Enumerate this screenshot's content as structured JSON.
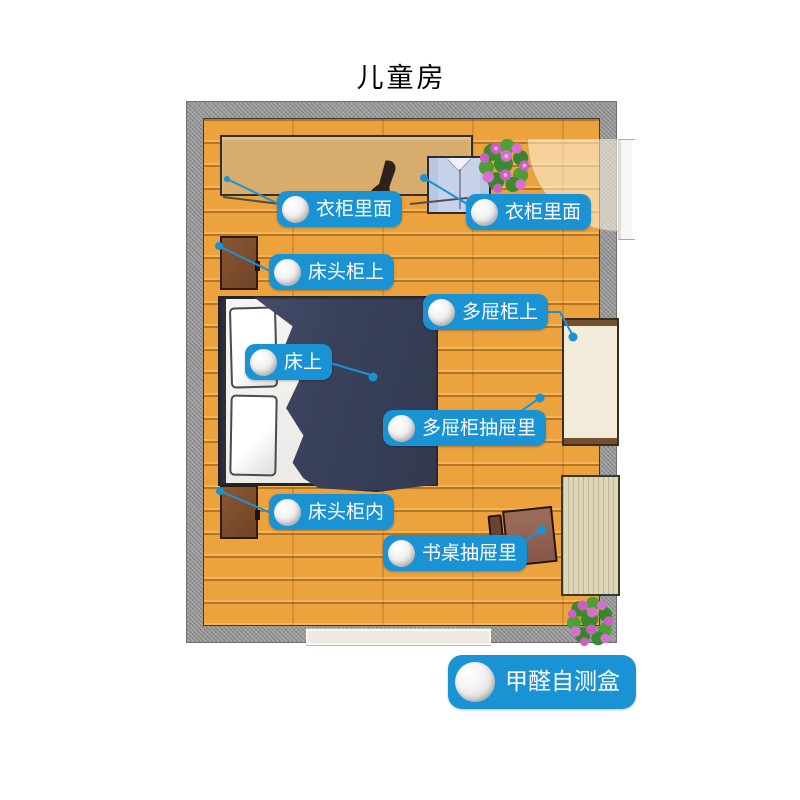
{
  "title": "儿童房",
  "markers": [
    {
      "id": "wardrobe-left",
      "text": "衣柜里面"
    },
    {
      "id": "wardrobe-right",
      "text": "衣柜里面"
    },
    {
      "id": "nightstand-top",
      "text": "床头柜上"
    },
    {
      "id": "dresser-top",
      "text": "多屉柜上"
    },
    {
      "id": "bed-top",
      "text": "床上"
    },
    {
      "id": "dresser-drawer",
      "text": "多屉柜抽屉里"
    },
    {
      "id": "nightstand-inside",
      "text": "床头柜内"
    },
    {
      "id": "desk-drawer",
      "text": "书桌抽屉里"
    }
  ],
  "legend": {
    "text": "甲醛自测盒",
    "icon": "test-box-circle"
  },
  "colors": {
    "accent_blue": "#1a93d4",
    "floor_wood": "#eca23d",
    "wall_gray": "#9e9e9e",
    "blanket_navy": "#3a415c",
    "wardrobe_tan": "#d7ac6c"
  }
}
